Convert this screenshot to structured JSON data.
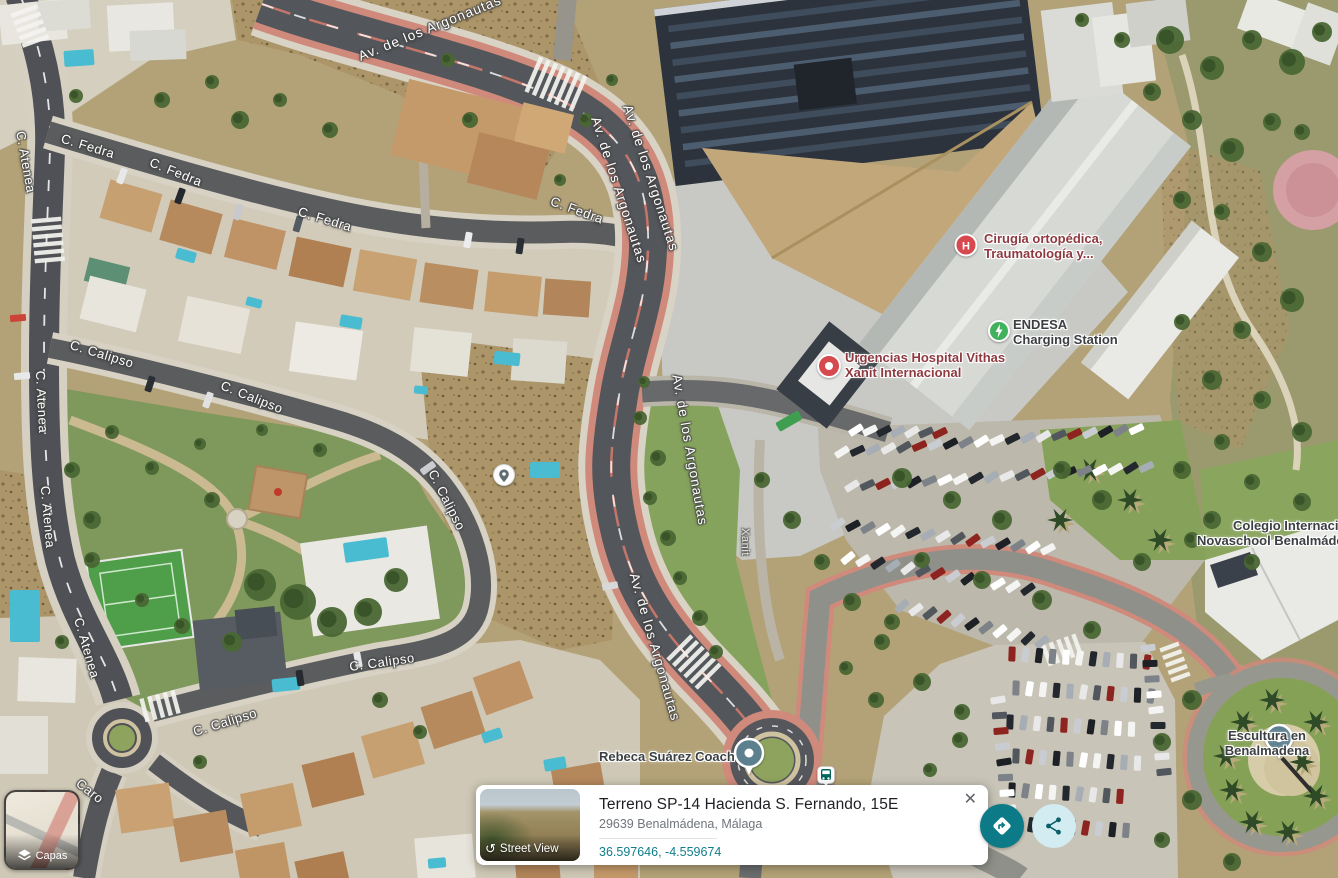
{
  "map": {
    "streets": {
      "atenea": "C. Atenea",
      "fedra": "C. Fedra",
      "calipso": "C. Calipso",
      "argonautas": "Av. de los Argonautas",
      "caro": "Caro",
      "xanit": "Xanit"
    },
    "pois": {
      "cirugia_line1": "Cirugía ortopédica,",
      "cirugia_line2": "Traumatología y...",
      "urgencias_line1": "Urgencias Hospital Vithas",
      "urgencias_line2": "Xanit Internacional",
      "endesa_line1": "ENDESA",
      "endesa_line2": "Charging Station",
      "colegio_line1": "Colegio Internacional",
      "colegio_line2": "Novaschool Benalmádena",
      "escultura_line1": "Escultura en",
      "escultura_line2": "Benalmadena",
      "rebeca": "Rebeca Suárez Coach"
    }
  },
  "card": {
    "title": "Terreno SP-14 Hacienda S. Fernando, 15E",
    "address": "29639 Benalmádena, Málaga",
    "coordinates": "36.597646, -4.559674",
    "street_view_label": "Street View"
  },
  "controls": {
    "layers_label": "Capas"
  },
  "icons": {
    "close": "✕",
    "street_view_arrow": "↺"
  },
  "colors": {
    "accent_teal": "#0c7b87",
    "coords_teal": "#0f7e8a",
    "pin_red": "#d6494e",
    "pin_green": "#41b15d",
    "pin_slate": "#5d808f"
  }
}
